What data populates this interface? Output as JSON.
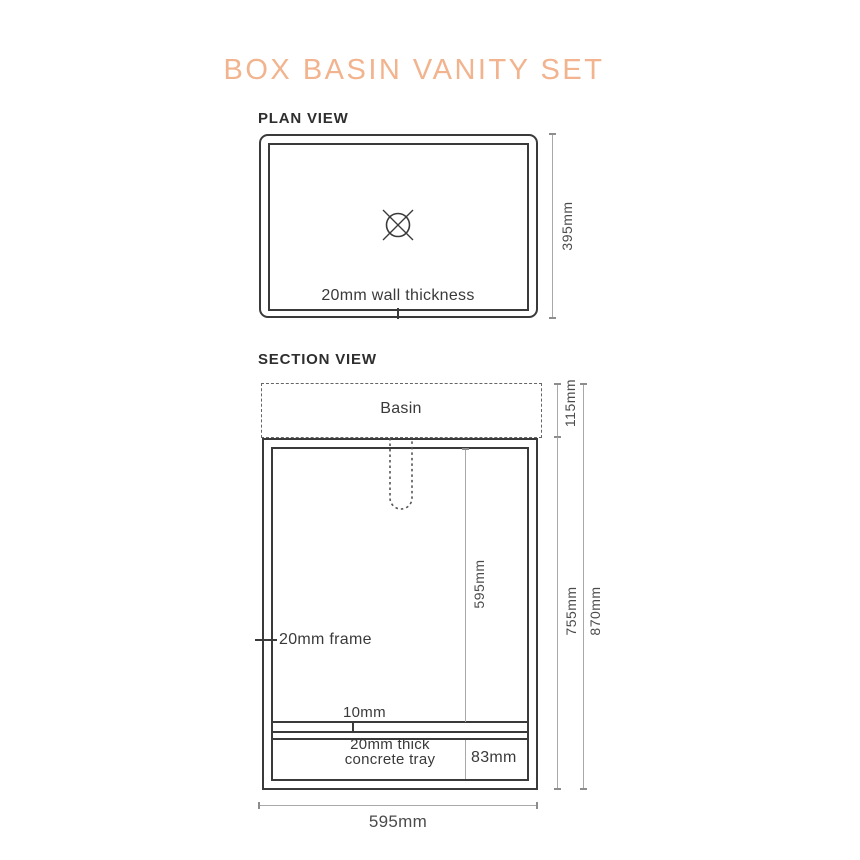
{
  "title": "BOX BASIN VANITY SET",
  "colors": {
    "accent": "#f2b48e",
    "ink": "#3a3a3a",
    "dim_line": "#a8a8a8"
  },
  "plan": {
    "label": "PLAN VIEW",
    "wall_thickness": "20mm wall thickness",
    "depth": "395mm"
  },
  "section": {
    "label": "SECTION VIEW",
    "basin": "Basin",
    "basin_height": "115mm",
    "inner_height": "595mm",
    "frame": "20mm frame",
    "gap": "10mm",
    "tray_thickness": "20mm thick",
    "tray_name": "concrete tray",
    "tray_height": "83mm",
    "cabinet_height": "755mm",
    "total_height": "870mm",
    "width": "595mm"
  }
}
